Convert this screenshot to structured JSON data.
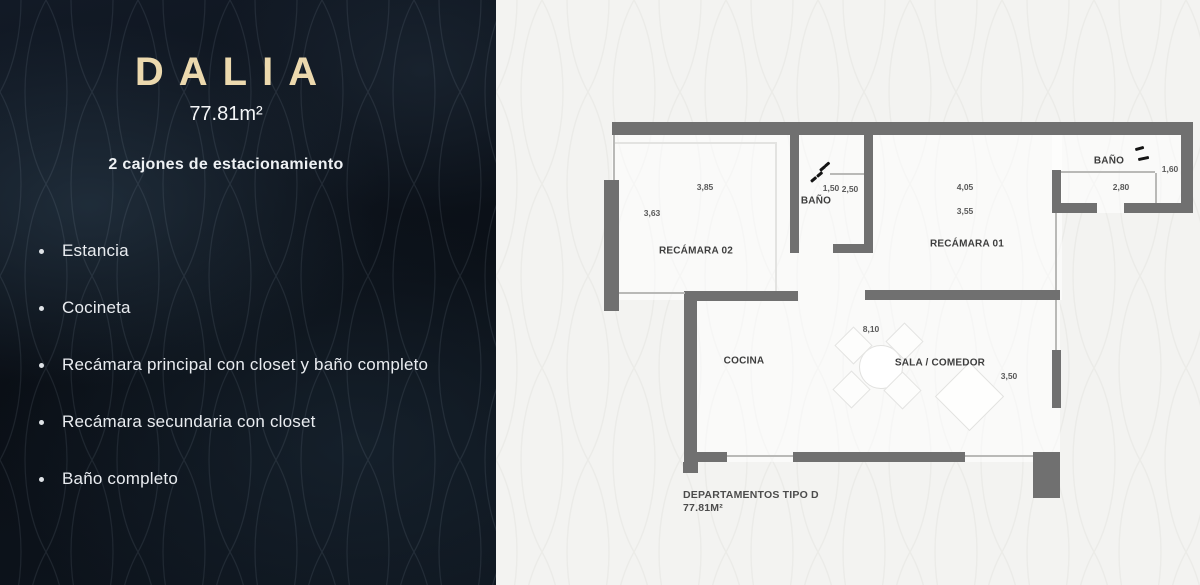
{
  "panel": {
    "title": "DALIA",
    "area": "77.81m²",
    "parking": "2 cajones de estacionamiento",
    "features": [
      "Estancia",
      "Cocineta",
      "Recámara principal con closet y baño completo",
      "Recámara secundaria con closet",
      "Baño completo"
    ]
  },
  "plan": {
    "rooms": {
      "bedroom2": "RECÁMARA 02",
      "bedroom1": "RECÁMARA 01",
      "bath_mid": "BAÑO",
      "bath_top": "BAÑO",
      "kitchen": "COCINA",
      "living": "SALA / COMEDOR"
    },
    "dims": {
      "bed2_w": "3,85",
      "bed2_h": "3,63",
      "bath_mid_w": "1,50",
      "bath_mid_h": "2,50",
      "bed1_w": "4,05",
      "bed1_h": "3,55",
      "bath_top_w": "2,80",
      "bath_top_h": "1,60",
      "living_w": "8,10",
      "living_h": "3,50"
    },
    "footer_line1": "DEPARTAMENTOS TIPO D",
    "footer_line2": "77.81M²"
  },
  "icons": {
    "bath_mid": "steam-dashes-icon",
    "bath_top": "steam-waves-icon"
  },
  "colors": {
    "accent_gold": "#ecd9ae",
    "panel_bg": "#0c1219",
    "canvas_bg": "#f3f3f1",
    "wall_gray": "#707070"
  }
}
